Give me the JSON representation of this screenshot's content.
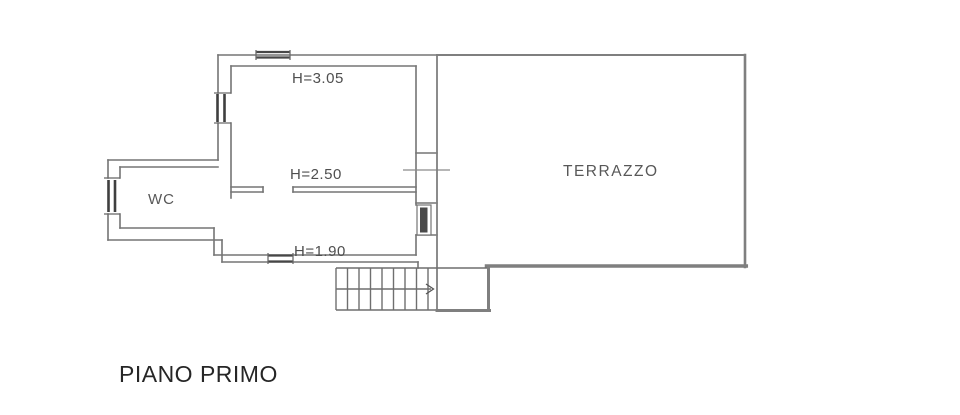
{
  "plan": {
    "floor_label": "PIANO PRIMO",
    "rooms": {
      "wc": {
        "label": "WC"
      },
      "terrazzo": {
        "label": "TERRAZZO"
      }
    },
    "height_annotations": {
      "upper_room": "H=3.05",
      "middle_room": "H=2.50",
      "lower_room": "H=1.90"
    },
    "colors": {
      "background": "#ffffff",
      "wall_line": "#757575",
      "terrace_line": "#7f7f7f",
      "window_dark": "#3f3f3f",
      "annotation_text": "#4f4f4f",
      "floor_label_text": "#262626"
    }
  }
}
